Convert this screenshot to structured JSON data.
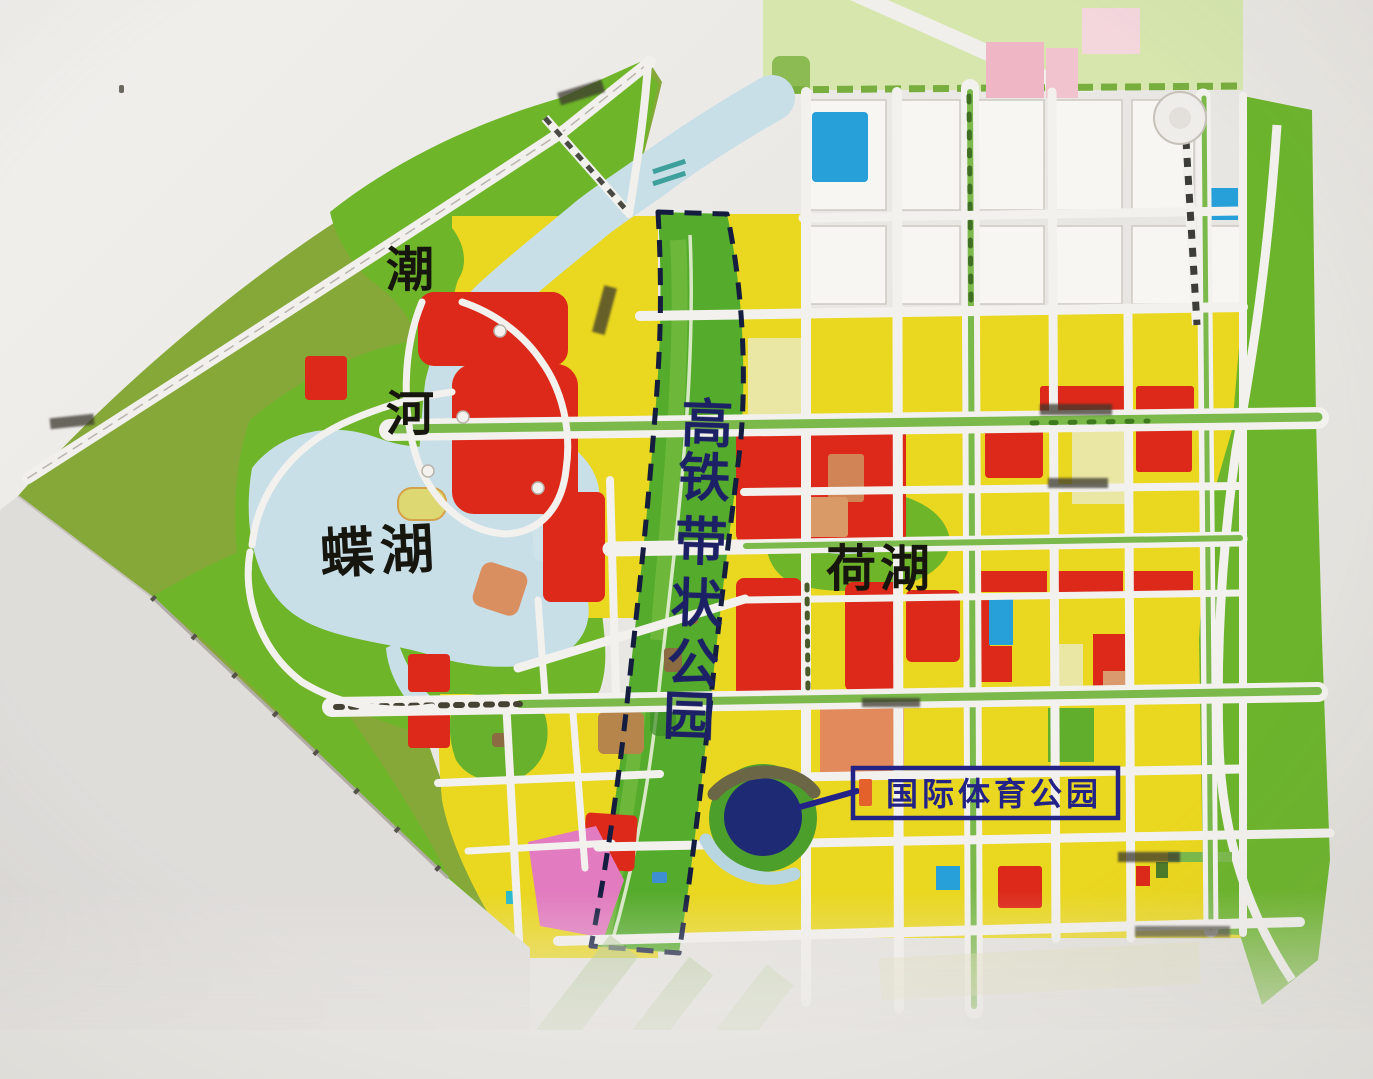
{
  "map": {
    "labels": {
      "river_name_chars": [
        "潮",
        "河"
      ],
      "west_lake": "蝶湖",
      "east_lake": "荷湖",
      "rail_belt_park_chars": [
        "高",
        "铁",
        "带",
        "状",
        "公",
        "园"
      ],
      "sports_park": "国际体育公园"
    },
    "colors": {
      "parkland_olive": "#86a83c",
      "park_green": "#6fb42c",
      "corridor_green": "#57aa2e",
      "water_blue": "#c9dfe8",
      "residential_yellow": "#e9d724",
      "commercial_red": "#d92a1b",
      "civic_blue": "#2a9ed6",
      "pink_parcel": "#eeb7c6",
      "magenta_parcel": "#e07cbe",
      "stadium_navy": "#1e2a72",
      "annotation_navy": "#232384",
      "label_black": "#16150e"
    }
  }
}
